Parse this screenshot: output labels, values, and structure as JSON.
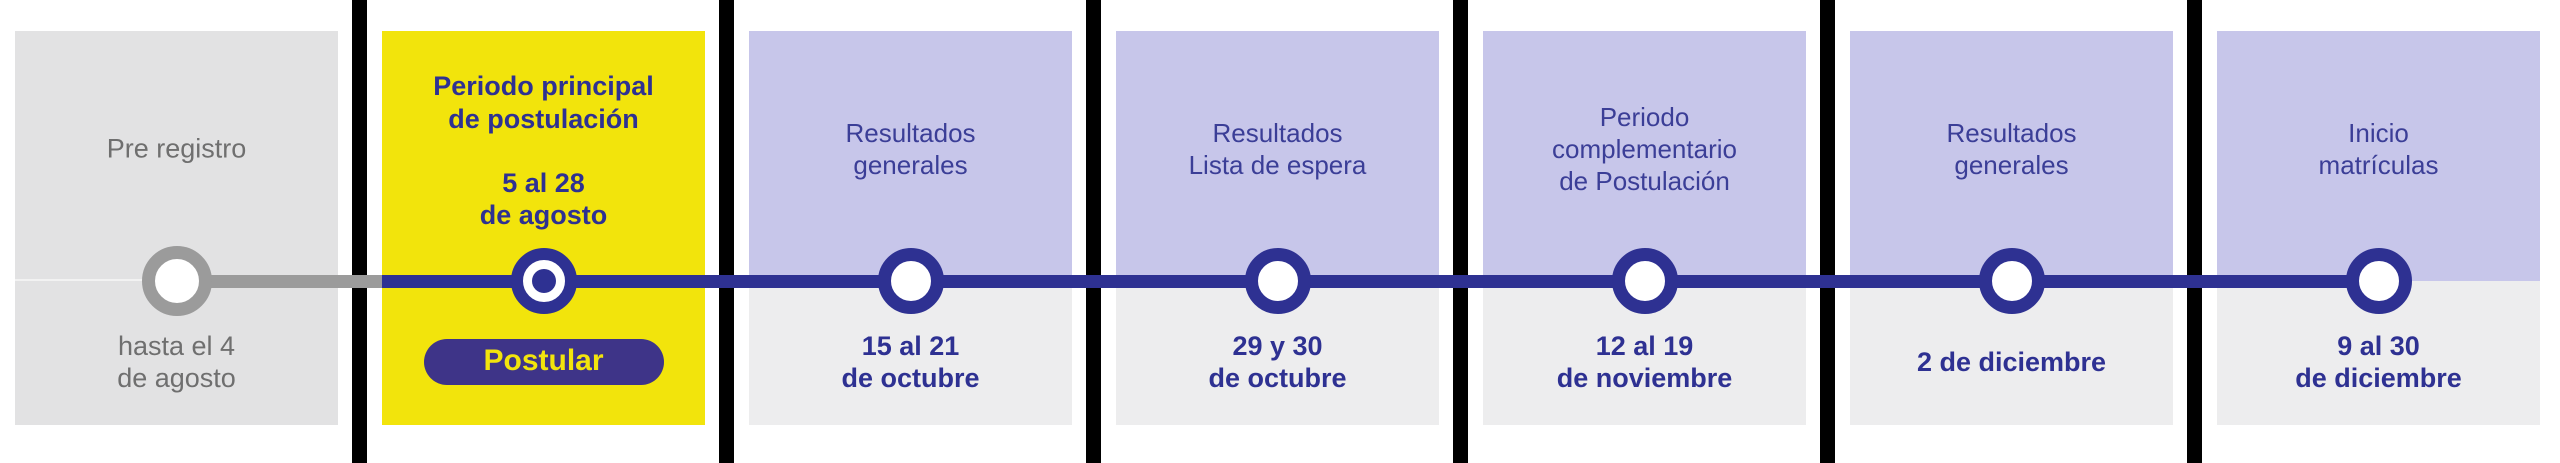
{
  "timeline": {
    "stages": [
      {
        "title": "Pre registro",
        "date": "hasta el 4\nde agosto",
        "state": "past"
      },
      {
        "title": "Periodo principal\nde postulación",
        "date": "5 al 28\nde agosto",
        "state": "active",
        "button_label": "Postular"
      },
      {
        "title": "Resultados\ngenerales",
        "date": "15 al 21\nde octubre",
        "state": "upcoming"
      },
      {
        "title": "Resultados\nLista de espera",
        "date": "29 y 30\nde octubre",
        "state": "upcoming"
      },
      {
        "title": "Periodo\ncomplementario\nde Postulación",
        "date": "12 al 19\nde noviembre",
        "state": "upcoming"
      },
      {
        "title": "Resultados\ngenerales",
        "date": "2 de diciembre",
        "state": "upcoming"
      },
      {
        "title": "Inicio\nmatrículas",
        "date": "9 al 30\nde diciembre",
        "state": "upcoming"
      }
    ],
    "colors": {
      "accent_blue": "#2e3192",
      "inactive_gray": "#9b9b9b",
      "highlight_yellow": "#f2e40c",
      "lavender": "#c7c6ea",
      "section_gray": "#ededee",
      "panel_gray": "#e2e2e3",
      "button_purple": "#3e3488",
      "divider_black": "#000000",
      "muted_text_gray": "#6f6f6f",
      "label_blue": "#3b3e97"
    }
  }
}
